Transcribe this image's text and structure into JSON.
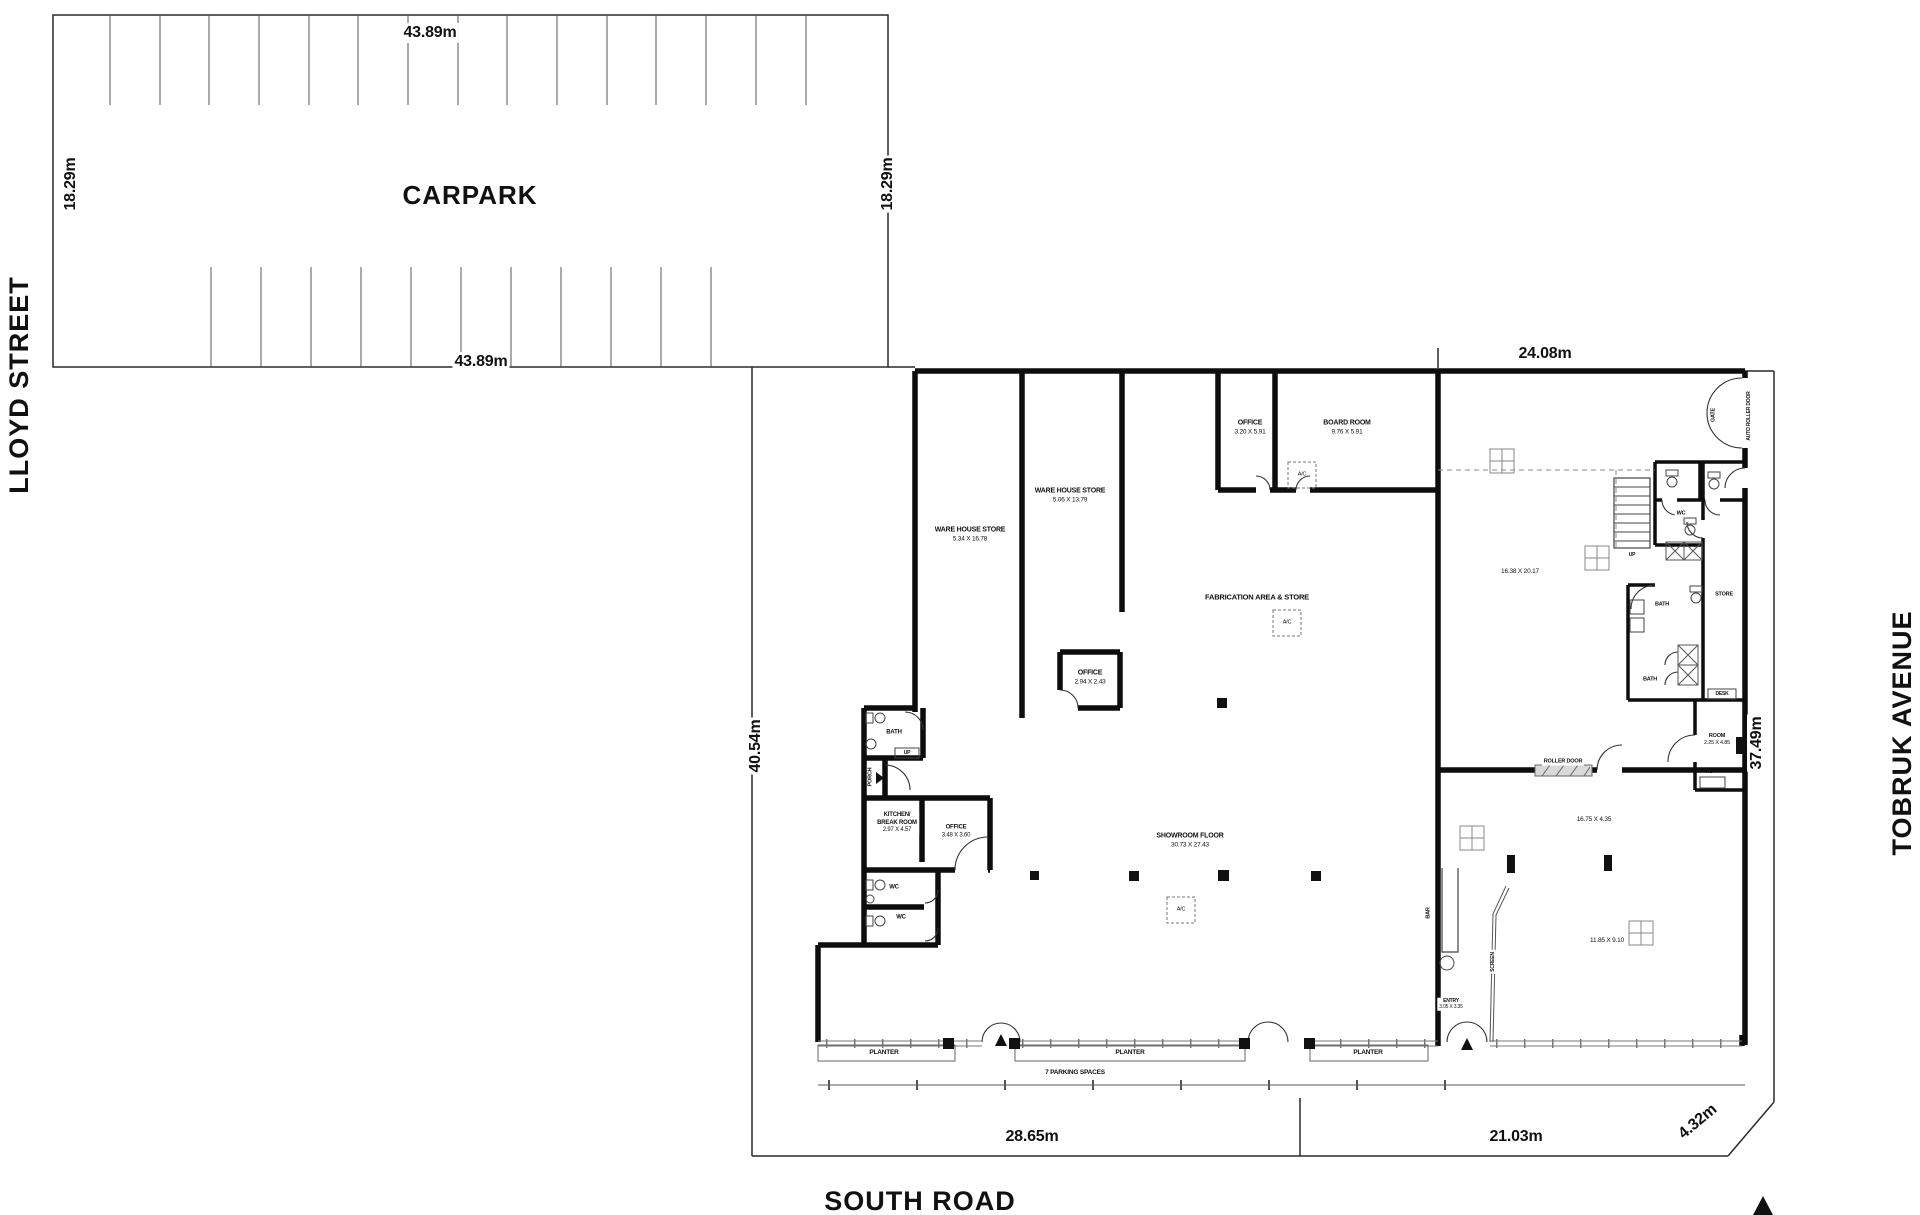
{
  "streets": {
    "left": "LLOYD STREET",
    "bottom": "SOUTH ROAD",
    "right": "TOBRUK AVENUE"
  },
  "carpark": {
    "title": "CARPARK",
    "dim_top": "43.89m",
    "dim_bottom": "43.89m",
    "dim_left": "18.29m",
    "dim_right": "18.29m"
  },
  "site_dims": {
    "top": "24.08m",
    "left": "40.54m",
    "right": "37.49m",
    "bottom_left": "28.65m",
    "bottom_right": "21.03m",
    "corner": "4.32m"
  },
  "rooms": {
    "warehouse1": {
      "name": "WARE HOUSE STORE",
      "dims": "5.34 X 16.78"
    },
    "warehouse2": {
      "name": "WARE HOUSE STORE",
      "dims": "5.06 X 13.79"
    },
    "office_top": {
      "name": "OFFICE",
      "dims": "3.20 X 5.91"
    },
    "board_room": {
      "name": "BOARD ROOM",
      "dims": "9.76 X 5.91"
    },
    "fabrication": {
      "name": "FABRICATION AREA & STORE"
    },
    "office_small": {
      "name": "OFFICE",
      "dims": "2.94 X 2.43"
    },
    "showroom": {
      "name": "SHOWROOM FLOOR",
      "dims": "30.73 X 27.43"
    },
    "kitchen": {
      "name": "KITCHEN/",
      "name2": "BREAK ROOM",
      "dims": "2.97 X 4.57"
    },
    "office_mid": {
      "name": "OFFICE",
      "dims": "3.48 X 3.60"
    },
    "bath_left": {
      "name": "BATH"
    },
    "up_left": {
      "name": "UP"
    },
    "porch": {
      "name": "PORCH"
    },
    "wc_top": {
      "name": "WC"
    },
    "wc_bottom": {
      "name": "WC"
    },
    "area_upper_right": {
      "dims": "16.38 X 20.17"
    },
    "up_right": {
      "name": "UP"
    },
    "wc_right": {
      "name": "WC"
    },
    "store_right": {
      "name": "STORE"
    },
    "bath_right_upper": {
      "name": "BATH"
    },
    "bath_right_lower": {
      "name": "BATH"
    },
    "desk": {
      "name": "DESK"
    },
    "room_right": {
      "name": "ROOM",
      "dims": "2.25 X 4.85"
    },
    "ac_unit": {
      "name": "AC"
    },
    "gate": {
      "name": "GATE"
    },
    "auto_roller_door": {
      "name": "AUTO ROLLER DOOR"
    },
    "roller_door": {
      "name": "ROLLER DOOR"
    },
    "area_mid_right": {
      "dims": "16.75 X 4.35"
    },
    "bar": {
      "name": "BAR"
    },
    "screen": {
      "name": "SCREEN"
    },
    "entry": {
      "name": "ENTRY",
      "dims": "3.05 X 3.35"
    },
    "area_lower_right": {
      "dims": "11.85 X 9.10"
    }
  },
  "labels": {
    "planter": "PLANTER",
    "parking": "7 PARKING SPACES",
    "ac": "A/C"
  }
}
